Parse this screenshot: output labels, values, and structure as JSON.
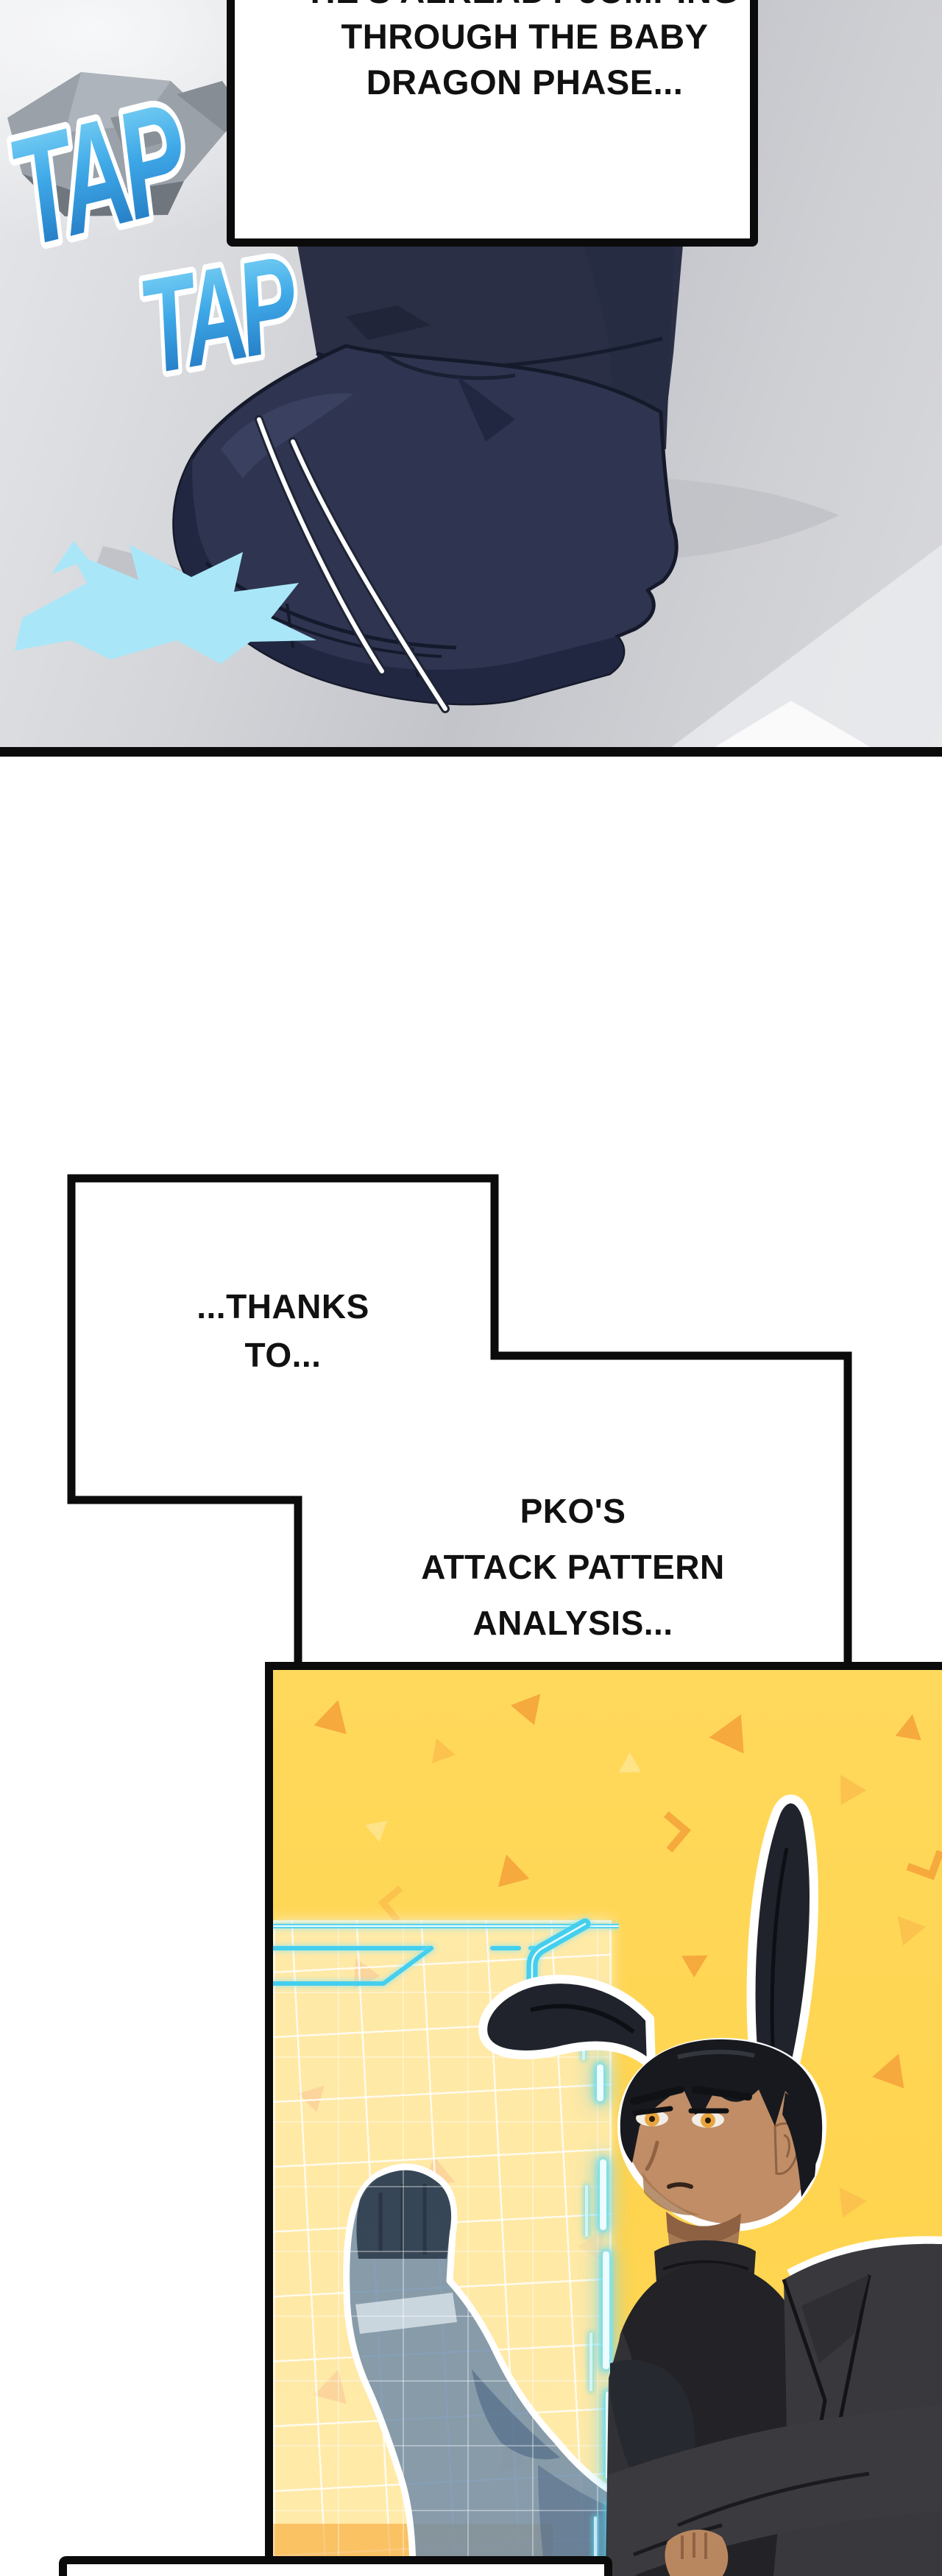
{
  "panel_boot": {
    "sfx_tap_1": "TAP",
    "sfx_tap_2": "TAP",
    "bubble_top": {
      "line1": "HE'S ALREADY JUMPING",
      "line2": "THROUGH THE BABY",
      "line3": "DRAGON PHASE..."
    }
  },
  "bubble_thanks": {
    "line1": "...THANKS",
    "line2": "TO..."
  },
  "bubble_pko": {
    "line1": "PKO'S",
    "line2": "ATTACK PATTERN",
    "line3": "ANALYSIS..."
  },
  "bubble_bottom": {
    "text": ""
  },
  "colors": {
    "ink_outline": "#0B0B0B",
    "sfx_blue_top": "#8FDFF8",
    "sfx_blue_mid": "#3FA9E8",
    "sfx_blue_deep": "#1B6CB8",
    "splash_cyan": "#A9E7F8",
    "floor_gray": "#CDCED3",
    "boot_navy": "#2F3550",
    "panel_yellow": "#FFD95C",
    "triangle_orange": "#F6A93C",
    "hologram_cyan": "#44CFEE",
    "hologram_body_blue": "#6C8AAA",
    "skin_tan": "#C08D66",
    "hair_black": "#17191F",
    "eye_amber": "#E8A43F",
    "jacket_charcoal": "#3A3A3F"
  }
}
